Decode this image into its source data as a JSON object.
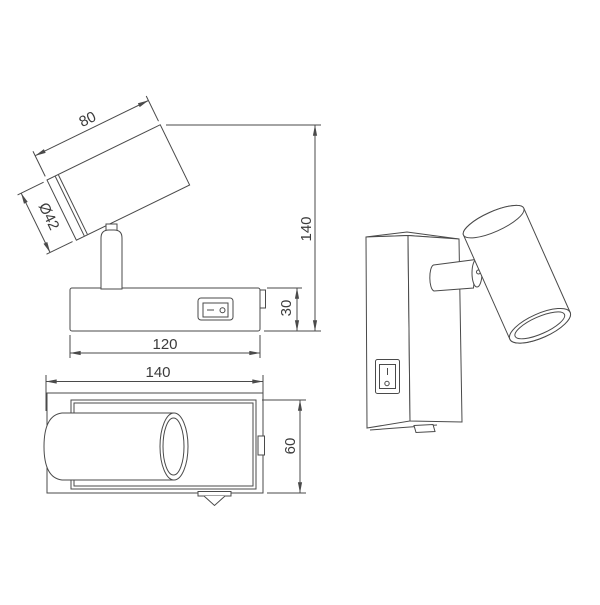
{
  "drawing": {
    "background": "#ffffff",
    "line_color": "#4a4a4a",
    "text_color": "#3b3b3b",
    "side_view": {
      "head_length": "80",
      "head_diameter": "Ø42",
      "overall_height": "140",
      "base_height": "30",
      "base_width": "120"
    },
    "top_view": {
      "overall_depth": "140",
      "base_depth": "60"
    }
  }
}
